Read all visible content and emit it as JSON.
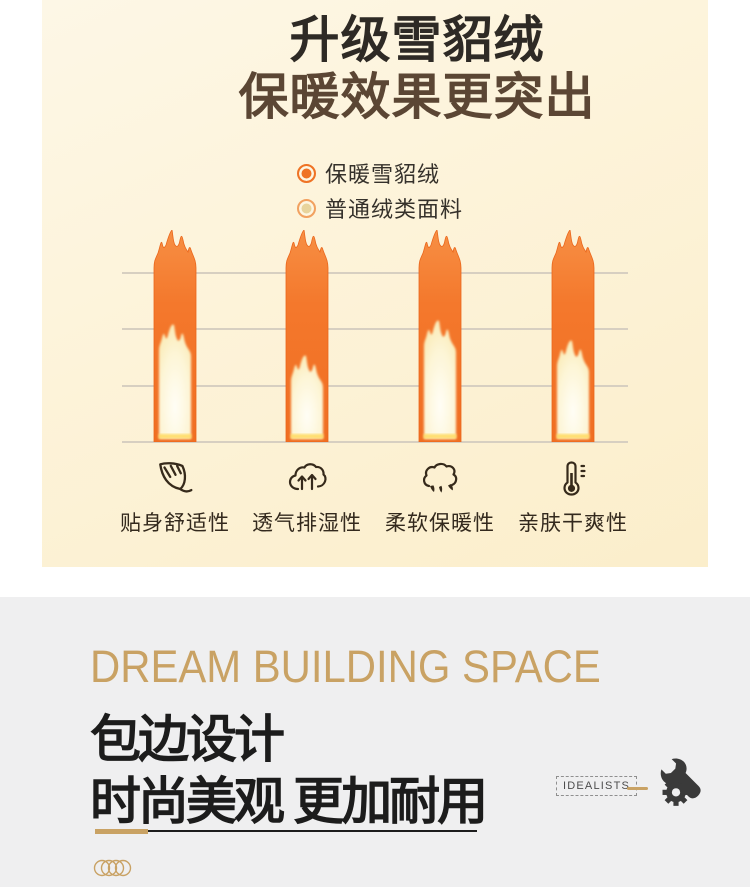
{
  "hero": {
    "title_line1": "升级雪貂绒",
    "title_line2": "保暖效果更突出",
    "bg_color": "#fdf3d9",
    "legend": [
      {
        "label": "保暖雪貂绒",
        "core": "#ef7325",
        "ring": "#ef7325"
      },
      {
        "label": "普通绒类面料",
        "core": "#e8d49c",
        "ring": "#f2a160"
      }
    ],
    "features": [
      {
        "icon": "leaf-icon",
        "label": "贴身舒适性"
      },
      {
        "icon": "breathable-cloud-icon",
        "label": "透气排湿性"
      },
      {
        "icon": "cotton-icon",
        "label": "柔软保暖性"
      },
      {
        "icon": "thermometer-icon",
        "label": "亲肤干爽性"
      }
    ]
  },
  "chart_data": {
    "type": "bar",
    "categories": [
      "贴身舒适性",
      "透气排湿性",
      "柔软保暖性",
      "亲肤干爽性"
    ],
    "series": [
      {
        "name": "保暖雪貂绒",
        "values": [
          100,
          100,
          100,
          100
        ],
        "color": "#f4772b"
      },
      {
        "name": "普通绒类面料",
        "values": [
          45,
          29,
          47,
          37
        ],
        "color": "#fdf2cd"
      }
    ],
    "ylim": [
      0,
      100
    ],
    "grid": true,
    "gridline_count": 4,
    "legend_position": "top",
    "note": "flame-shaped bars; no numeric axis labels shown, values are relative warmth levels"
  },
  "design_section": {
    "eyebrow": "DREAM BUILDING SPACE",
    "heading_line1": "包边设计",
    "heading_line2": "时尚美观 更加耐用",
    "badge_label": "IDEALISTS",
    "dash": "—",
    "icons": [
      "gear-icon",
      "wrench-icon",
      "overlapping-rings-icon"
    ],
    "colors": {
      "gold": "#c9a264",
      "heading": "#1c1c1c",
      "bg": "#efeff0"
    }
  }
}
